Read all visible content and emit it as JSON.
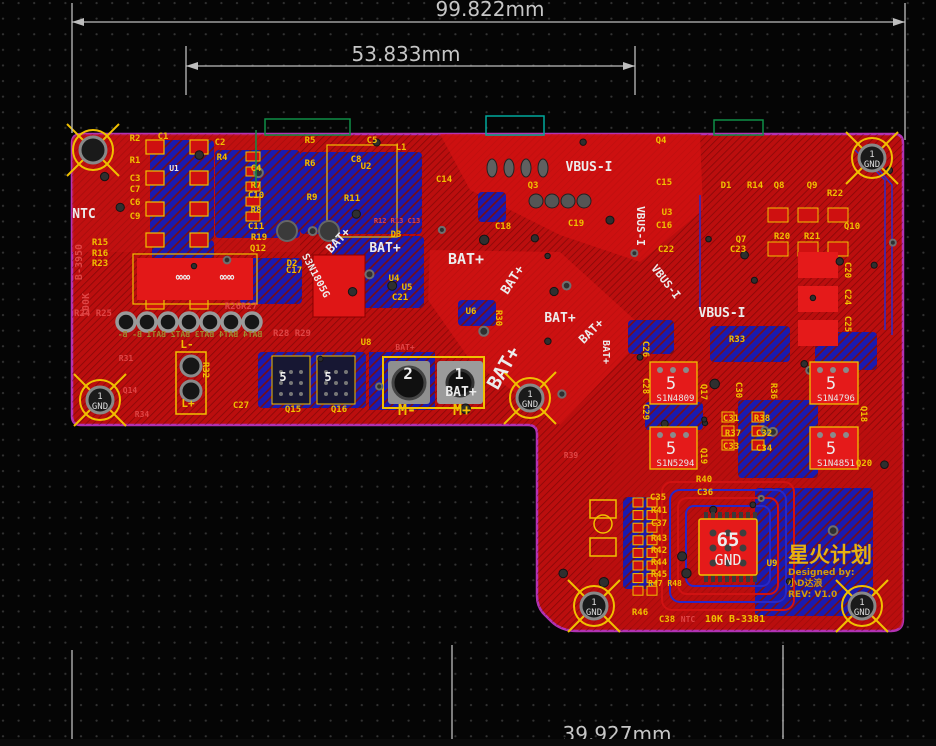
{
  "dimensions": {
    "top": "99.822mm",
    "middle": "53.833mm",
    "bottom": "39.927mm"
  },
  "watermark": {
    "title": "星火计划",
    "designed_by": "Designed by:",
    "author": "小D达浪",
    "revision": "REV: V1.0"
  },
  "board": {
    "labels": [
      {
        "t": "BAT+",
        "x": 385,
        "y": 252,
        "c": "w",
        "s": 13
      },
      {
        "t": "BAT+",
        "x": 466,
        "y": 264,
        "c": "w",
        "s": 15
      },
      {
        "t": "BAT+",
        "x": 341,
        "y": 243,
        "c": "w",
        "s": 12,
        "r": -47
      },
      {
        "t": "BAT+",
        "x": 516,
        "y": 282,
        "c": "w",
        "s": 13,
        "r": -57
      },
      {
        "t": "BAT+",
        "x": 560,
        "y": 322,
        "c": "w",
        "s": 13
      },
      {
        "t": "BAT+",
        "x": 594,
        "y": 334,
        "c": "w",
        "s": 12,
        "r": -45
      },
      {
        "t": "BAT+",
        "x": 509,
        "y": 371,
        "c": "w",
        "s": 19,
        "r": -60
      },
      {
        "t": "BAT+",
        "x": 461,
        "y": 396,
        "c": "w",
        "s": 13
      },
      {
        "t": "BAT+",
        "x": 603,
        "y": 352,
        "c": "w",
        "s": 10,
        "r": 90
      },
      {
        "t": "VBUS-I",
        "x": 589,
        "y": 171,
        "c": "w",
        "s": 13
      },
      {
        "t": "VBUS-I",
        "x": 637,
        "y": 226,
        "c": "w",
        "s": 11,
        "r": 90
      },
      {
        "t": "VBUS-I",
        "x": 663,
        "y": 284,
        "c": "w",
        "s": 11,
        "r": 52
      },
      {
        "t": "VBUS-I",
        "x": 722,
        "y": 317,
        "c": "w",
        "s": 13
      },
      {
        "t": "NTC",
        "x": 84,
        "y": 218,
        "c": "w",
        "s": 13
      },
      {
        "t": "U1",
        "x": 174,
        "y": 171,
        "c": "w",
        "s": 8
      },
      {
        "t": "S3N1805G",
        "x": 313,
        "y": 277,
        "c": "w",
        "s": 10,
        "r": 62
      },
      {
        "t": "∞∞",
        "x": 183,
        "y": 281,
        "c": "w",
        "s": 12
      },
      {
        "t": "∞∞",
        "x": 227,
        "y": 281,
        "c": "w",
        "s": 12
      },
      {
        "t": "2",
        "x": 408,
        "y": 379,
        "c": "w",
        "s": 16
      },
      {
        "t": "1",
        "x": 459,
        "y": 379,
        "c": "w",
        "s": 15
      },
      {
        "t": "5",
        "x": 283,
        "y": 381,
        "c": "w",
        "s": 12
      },
      {
        "t": "5",
        "x": 328,
        "y": 381,
        "c": "w",
        "s": 12
      },
      {
        "t": "C1",
        "x": 163,
        "y": 139,
        "c": "y"
      },
      {
        "t": "R2",
        "x": 135,
        "y": 141,
        "c": "y"
      },
      {
        "t": "R1",
        "x": 135,
        "y": 163,
        "c": "y"
      },
      {
        "t": "C3",
        "x": 135,
        "y": 181,
        "c": "y"
      },
      {
        "t": "C7",
        "x": 135,
        "y": 192,
        "c": "y"
      },
      {
        "t": "C6",
        "x": 135,
        "y": 205,
        "c": "y"
      },
      {
        "t": "C9",
        "x": 135,
        "y": 219,
        "c": "y"
      },
      {
        "t": "R15",
        "x": 100,
        "y": 245,
        "c": "y"
      },
      {
        "t": "R16",
        "x": 100,
        "y": 256,
        "c": "y"
      },
      {
        "t": "R23",
        "x": 100,
        "y": 266,
        "c": "y"
      },
      {
        "t": "C2",
        "x": 220,
        "y": 145,
        "c": "y"
      },
      {
        "t": "R4",
        "x": 222,
        "y": 160,
        "c": "y"
      },
      {
        "t": "C4",
        "x": 256,
        "y": 171,
        "c": "y"
      },
      {
        "t": "R7",
        "x": 256,
        "y": 188,
        "c": "y"
      },
      {
        "t": "C10",
        "x": 256,
        "y": 198,
        "c": "y"
      },
      {
        "t": "R8",
        "x": 256,
        "y": 213,
        "c": "y"
      },
      {
        "t": "C11",
        "x": 256,
        "y": 229,
        "c": "y"
      },
      {
        "t": "R19",
        "x": 259,
        "y": 240,
        "c": "y"
      },
      {
        "t": "Q12",
        "x": 258,
        "y": 251,
        "c": "y"
      },
      {
        "t": "R5",
        "x": 310,
        "y": 143,
        "c": "y"
      },
      {
        "t": "R6",
        "x": 310,
        "y": 166,
        "c": "y"
      },
      {
        "t": "R9",
        "x": 312,
        "y": 200,
        "c": "y"
      },
      {
        "t": "R11",
        "x": 352,
        "y": 201,
        "c": "y"
      },
      {
        "t": "C5",
        "x": 372,
        "y": 143,
        "c": "y"
      },
      {
        "t": "L1",
        "x": 401,
        "y": 150,
        "c": "y"
      },
      {
        "t": "C8",
        "x": 356,
        "y": 162,
        "c": "y"
      },
      {
        "t": "U2",
        "x": 366,
        "y": 169,
        "c": "y"
      },
      {
        "t": "C14",
        "x": 444,
        "y": 182,
        "c": "y"
      },
      {
        "t": "Q3",
        "x": 533,
        "y": 188,
        "c": "y"
      },
      {
        "t": "Q4",
        "x": 661,
        "y": 143,
        "c": "y"
      },
      {
        "t": "C15",
        "x": 664,
        "y": 185,
        "c": "y"
      },
      {
        "t": "U3",
        "x": 667,
        "y": 215,
        "c": "y"
      },
      {
        "t": "C16",
        "x": 664,
        "y": 228,
        "c": "y"
      },
      {
        "t": "C22",
        "x": 666,
        "y": 252,
        "c": "y"
      },
      {
        "t": "C18",
        "x": 503,
        "y": 229,
        "c": "y"
      },
      {
        "t": "C19",
        "x": 576,
        "y": 226,
        "c": "y"
      },
      {
        "t": "D3",
        "x": 396,
        "y": 237,
        "c": "y"
      },
      {
        "t": "D2",
        "x": 292,
        "y": 266,
        "c": "y"
      },
      {
        "t": "C17",
        "x": 294,
        "y": 273,
        "c": "y"
      },
      {
        "t": "U4",
        "x": 394,
        "y": 281,
        "c": "y"
      },
      {
        "t": "U5",
        "x": 407,
        "y": 290,
        "c": "y"
      },
      {
        "t": "C21",
        "x": 400,
        "y": 300,
        "c": "y"
      },
      {
        "t": "U6",
        "x": 471,
        "y": 314,
        "c": "y"
      },
      {
        "t": "R30",
        "x": 496,
        "y": 318,
        "c": "y",
        "r": 90
      },
      {
        "t": "D1",
        "x": 726,
        "y": 188,
        "c": "y"
      },
      {
        "t": "R14",
        "x": 755,
        "y": 188,
        "c": "y"
      },
      {
        "t": "Q8",
        "x": 779,
        "y": 188,
        "c": "y"
      },
      {
        "t": "Q9",
        "x": 812,
        "y": 188,
        "c": "y"
      },
      {
        "t": "R22",
        "x": 835,
        "y": 196,
        "c": "y"
      },
      {
        "t": "R20",
        "x": 782,
        "y": 239,
        "c": "y"
      },
      {
        "t": "R21",
        "x": 812,
        "y": 239,
        "c": "y"
      },
      {
        "t": "Q10",
        "x": 852,
        "y": 229,
        "c": "y"
      },
      {
        "t": "Q7",
        "x": 741,
        "y": 242,
        "c": "y"
      },
      {
        "t": "C23",
        "x": 738,
        "y": 252,
        "c": "y"
      },
      {
        "t": "R33",
        "x": 737,
        "y": 342,
        "c": "y"
      },
      {
        "t": "C26",
        "x": 643,
        "y": 349,
        "c": "y",
        "r": 90
      },
      {
        "t": "C28",
        "x": 643,
        "y": 386,
        "c": "y",
        "r": 90
      },
      {
        "t": "C29",
        "x": 643,
        "y": 412,
        "c": "y",
        "r": 90
      },
      {
        "t": "C20",
        "x": 845,
        "y": 270,
        "c": "y",
        "r": 90
      },
      {
        "t": "C24",
        "x": 845,
        "y": 297,
        "c": "y",
        "r": 90
      },
      {
        "t": "C25",
        "x": 845,
        "y": 324,
        "c": "y",
        "r": 90
      },
      {
        "t": "C30",
        "x": 736,
        "y": 390,
        "c": "y",
        "r": 90
      },
      {
        "t": "R36",
        "x": 771,
        "y": 391,
        "c": "y",
        "r": 90
      },
      {
        "t": "C31",
        "x": 731,
        "y": 421,
        "c": "y"
      },
      {
        "t": "R38",
        "x": 762,
        "y": 421,
        "c": "y"
      },
      {
        "t": "R37",
        "x": 733,
        "y": 436,
        "c": "y"
      },
      {
        "t": "C32",
        "x": 764,
        "y": 436,
        "c": "y"
      },
      {
        "t": "C33",
        "x": 731,
        "y": 449,
        "c": "y"
      },
      {
        "t": "C34",
        "x": 764,
        "y": 451,
        "c": "y"
      },
      {
        "t": "R40",
        "x": 704,
        "y": 482,
        "c": "y"
      },
      {
        "t": "C36",
        "x": 705,
        "y": 495,
        "c": "y"
      },
      {
        "t": "C35",
        "x": 658,
        "y": 500,
        "c": "y"
      },
      {
        "t": "R41",
        "x": 659,
        "y": 513,
        "c": "y"
      },
      {
        "t": "C37",
        "x": 659,
        "y": 526,
        "c": "y"
      },
      {
        "t": "R43",
        "x": 659,
        "y": 541,
        "c": "y"
      },
      {
        "t": "R42",
        "x": 659,
        "y": 553,
        "c": "y"
      },
      {
        "t": "R44",
        "x": 659,
        "y": 565,
        "c": "y"
      },
      {
        "t": "R45",
        "x": 659,
        "y": 577,
        "c": "y"
      },
      {
        "t": "R47 R48",
        "x": 665,
        "y": 586,
        "c": "y",
        "s": 8
      },
      {
        "t": "R46",
        "x": 640,
        "y": 615,
        "c": "y"
      },
      {
        "t": "C38",
        "x": 667,
        "y": 622,
        "c": "y"
      },
      {
        "t": "10K B-3381",
        "x": 735,
        "y": 622,
        "c": "y",
        "s": 10
      },
      {
        "t": "U9",
        "x": 772,
        "y": 566,
        "c": "y"
      },
      {
        "t": "U8",
        "x": 366,
        "y": 345,
        "c": "y"
      },
      {
        "t": "L-",
        "x": 187,
        "y": 348,
        "c": "y",
        "s": 11
      },
      {
        "t": "L+",
        "x": 188,
        "y": 407,
        "c": "y",
        "s": 11
      },
      {
        "t": "R32",
        "x": 203,
        "y": 370,
        "c": "y",
        "r": 90
      },
      {
        "t": "C27",
        "x": 241,
        "y": 408,
        "c": "y"
      },
      {
        "t": "Q15",
        "x": 293,
        "y": 412,
        "c": "y"
      },
      {
        "t": "Q16",
        "x": 339,
        "y": 412,
        "c": "y"
      },
      {
        "t": "Q17",
        "x": 701,
        "y": 392,
        "c": "y",
        "r": 90
      },
      {
        "t": "Q18",
        "x": 861,
        "y": 414,
        "c": "y",
        "r": 90
      },
      {
        "t": "Q19",
        "x": 701,
        "y": 456,
        "c": "y",
        "r": 90
      },
      {
        "t": "Q20",
        "x": 864,
        "y": 466,
        "c": "y"
      },
      {
        "t": "M-",
        "x": 407,
        "y": 415,
        "c": "y",
        "s": 15
      },
      {
        "t": "M+",
        "x": 462,
        "y": 415,
        "c": "y",
        "s": 15
      },
      {
        "t": "100K",
        "x": 89,
        "y": 305,
        "c": "r",
        "s": 10,
        "r": -90
      },
      {
        "t": "B-3950",
        "x": 82,
        "y": 262,
        "c": "r",
        "s": 10,
        "r": -90
      },
      {
        "t": "R24 R25",
        "x": 93,
        "y": 316,
        "c": "r"
      },
      {
        "t": "R26R27",
        "x": 241,
        "y": 309,
        "c": "r"
      },
      {
        "t": "R28 R29",
        "x": 292,
        "y": 336,
        "c": "r"
      },
      {
        "t": "R31",
        "x": 126,
        "y": 361,
        "c": "r",
        "s": 8
      },
      {
        "t": "Q14",
        "x": 130,
        "y": 393,
        "c": "r",
        "s": 8
      },
      {
        "t": "R34",
        "x": 142,
        "y": 417,
        "c": "r",
        "s": 8
      },
      {
        "t": "R39",
        "x": 571,
        "y": 458,
        "c": "r",
        "s": 8
      },
      {
        "t": "NTC",
        "x": 688,
        "y": 622,
        "c": "r",
        "s": 8
      },
      {
        "t": "R12 R13 C13",
        "x": 397,
        "y": 223,
        "c": "r",
        "s": 7
      },
      {
        "t": "BAT+",
        "x": 405,
        "y": 350,
        "c": "r",
        "s": 8
      },
      {
        "t": "BAT4 BAT4 BAT3 BAT2 BAT1 B- B-",
        "x": 190,
        "y": 337,
        "c": "m",
        "s": 8,
        "mi": true
      }
    ],
    "chips": [
      {
        "ref": "Q17",
        "mark": "5",
        "part": "S1N4809",
        "x": 650,
        "y": 362,
        "w": 47,
        "h": 42
      },
      {
        "ref": "Q18",
        "mark": "5",
        "part": "S1N4796",
        "x": 810,
        "y": 362,
        "w": 48,
        "h": 42
      },
      {
        "ref": "Q19",
        "mark": "5",
        "part": "S1N5294",
        "x": 650,
        "y": 427,
        "w": 47,
        "h": 42
      },
      {
        "ref": "Q20",
        "mark": "5",
        "part": "S1N4851",
        "x": 810,
        "y": 427,
        "w": 48,
        "h": 42
      }
    ],
    "qfn": {
      "mark": "65",
      "net": "GND",
      "x": 699,
      "y": 519,
      "w": 58,
      "h": 56
    },
    "holes": [
      {
        "x": 93,
        "y": 150
      },
      {
        "x": 872,
        "y": 158,
        "n": "1",
        "g": "GND"
      },
      {
        "x": 100,
        "y": 400,
        "n": "1",
        "g": "GND"
      },
      {
        "x": 530,
        "y": 398,
        "n": "1",
        "g": "GND"
      },
      {
        "x": 594,
        "y": 606,
        "n": "1",
        "g": "GND"
      },
      {
        "x": 862,
        "y": 606,
        "n": "1",
        "g": "GND"
      }
    ]
  }
}
